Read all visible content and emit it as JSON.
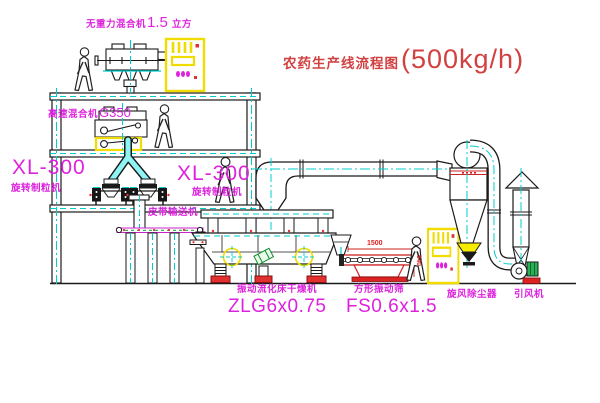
{
  "title": {
    "text": "农药生产线流程图",
    "capacity": "(500kg/h)"
  },
  "equipment_labels": {
    "top_mixer": {
      "prefix": "无重力混合机",
      "value": "1.5",
      "suffix": "立方"
    },
    "highspeed_mixer": {
      "prefix": "高速混合机",
      "value": "G350"
    },
    "granulator_left": {
      "model": "XL-300",
      "name": "旋转制粒机"
    },
    "granulator_right": {
      "model": "XL-300",
      "name": "旋转制粒机"
    },
    "belt_conveyor": {
      "name": "皮带输送机"
    },
    "dryer": {
      "name": "振动流化床干燥机",
      "model": "ZLG6x0.75"
    },
    "screen": {
      "name": "方形振动筛",
      "model": "FS0.6x1.5"
    },
    "cyclone": {
      "name": "旋风除尘器"
    },
    "fan": {
      "name": "引风机"
    }
  },
  "dimensions": {
    "screen_length": "1500",
    "screen_height": "540"
  },
  "colors": {
    "label_magenta": "#dd22dd",
    "title_red": "#d24040",
    "line_black": "#1a1a1a",
    "centerline_cyan": "#00cccc",
    "cabinet_yellow": "#f0dc00",
    "accent_red": "#dd2222",
    "motor_green": "#22aa44"
  }
}
